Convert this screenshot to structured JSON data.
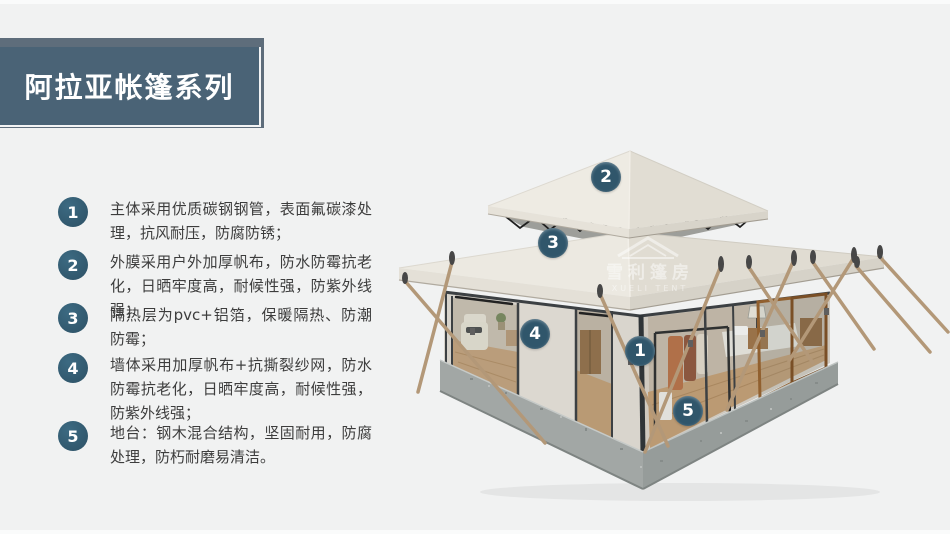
{
  "slide": {
    "background": "#f1f2f2",
    "accent_color": "#2f5569",
    "banner_color": "#4a6376",
    "banner_back_color": "#5e6d7b"
  },
  "title": {
    "text": "阿拉亚帐篷系列"
  },
  "features": [
    {
      "num": "1",
      "text": "主体采用优质碳钢钢管，表面氟碳漆处理，抗风耐压，防腐防锈；"
    },
    {
      "num": "2",
      "text": "外膜采用户外加厚帆布，防水防霉抗老化，日晒牢度高，耐候性强，防紫外线强；"
    },
    {
      "num": "3",
      "text": "隔热层为pvc+铝箔，保暖隔热、防潮防霉；"
    },
    {
      "num": "4",
      "text": "墙体采用加厚帆布+抗撕裂纱网，防水防霉抗老化，日晒牢度高，耐候性强，防紫外线强；"
    },
    {
      "num": "5",
      "text": "地台：钢木混合结构，坚固耐用，防腐处理，防朽耐磨易清洁。"
    }
  ],
  "callouts": [
    {
      "num": "1"
    },
    {
      "num": "2"
    },
    {
      "num": "3"
    },
    {
      "num": "4"
    },
    {
      "num": "5"
    }
  ],
  "watermark": {
    "line1": "雪利篷房",
    "line2": "XUELI TENT"
  }
}
